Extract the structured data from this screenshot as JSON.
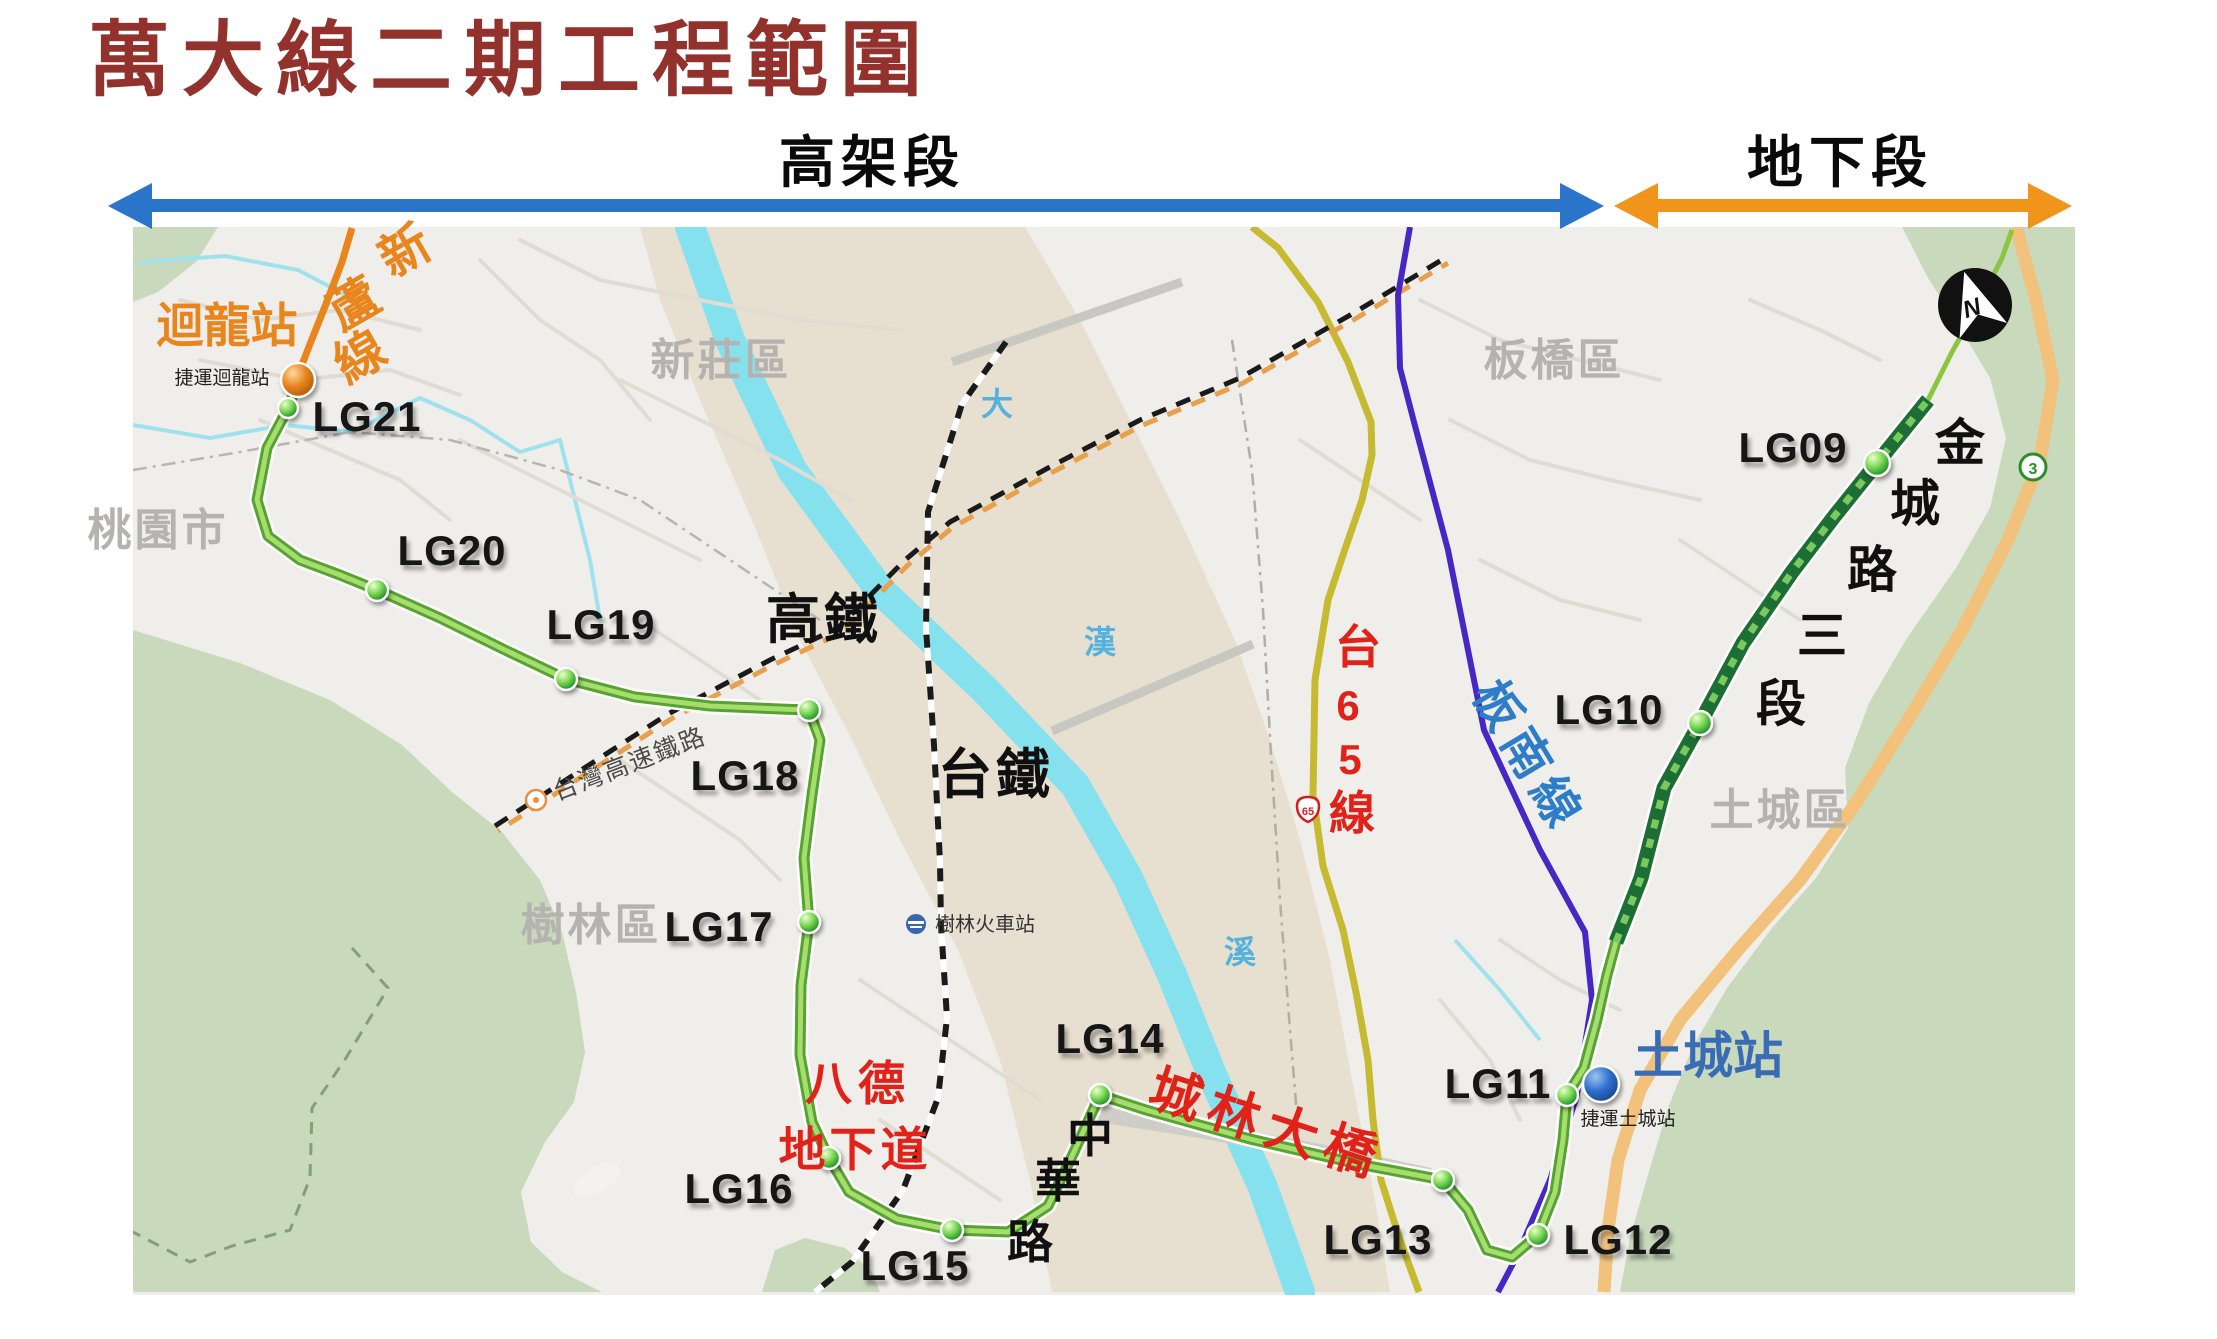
{
  "title": "萬大線二期工程範圍",
  "legend": {
    "elevated": "高架段",
    "underground": "地下段"
  },
  "stations": {
    "LG09": "LG09",
    "LG10": "LG10",
    "LG11": "LG11",
    "LG12": "LG12",
    "LG13": "LG13",
    "LG14": "LG14",
    "LG15": "LG15",
    "LG16": "LG16",
    "LG17": "LG17",
    "LG18": "LG18",
    "LG19": "LG19",
    "LG20": "LG20",
    "LG21": "LG21"
  },
  "places": {
    "taoyuan_city": "桃園市",
    "xinzhuang": "新莊區",
    "banqiao": "板橋區",
    "shulin": "樹林區",
    "tucheng": "土城區"
  },
  "named_stations": {
    "huilong": "迴龍站",
    "huilong_sub": "捷運迴龍站",
    "tucheng": "土城站",
    "tucheng_sub": "捷運土城站",
    "shulin_rail": "樹林火車站"
  },
  "lines": {
    "xinlu": [
      "新",
      "蘆",
      "線"
    ],
    "bannan": "板南線",
    "tai65": [
      "台",
      "6",
      "5",
      "線"
    ],
    "hsr_short": "高鐵",
    "tra_short": "台鐵",
    "thsr_full": "台灣高速鐵路"
  },
  "roads": {
    "bade": "八德",
    "underpass": "地下道",
    "chenglin_bridge": "城林大橋",
    "zhonghua": [
      "中",
      "華",
      "路"
    ],
    "jincheng": [
      "金",
      "城",
      "路",
      "三",
      "段"
    ],
    "shield65": "65",
    "shield3": "3"
  },
  "river": [
    "大",
    "漢",
    "溪"
  ],
  "compass": {
    "n": "N"
  },
  "colors": {
    "title": "#93322d",
    "elevated_arrow": "#2a74c9",
    "underground_arrow": "#f0941c",
    "metro_green": "#55a330",
    "metro_green_light": "#a6dd6e",
    "underground_green": "#1d6e34",
    "xinlu_orange": "#e8851c",
    "bannan_purple": "#4527c4",
    "tai65_yellow": "#c5ba30",
    "highway_orange": "#f2c27d",
    "red_label": "#e02218",
    "tucheng_blue": "#3a6cb5",
    "mountain_green": "#c8d9bc",
    "riverbed": "#e7dfd0",
    "river_cyan": "#86e1ef",
    "street_bg": "#f0eeea"
  }
}
